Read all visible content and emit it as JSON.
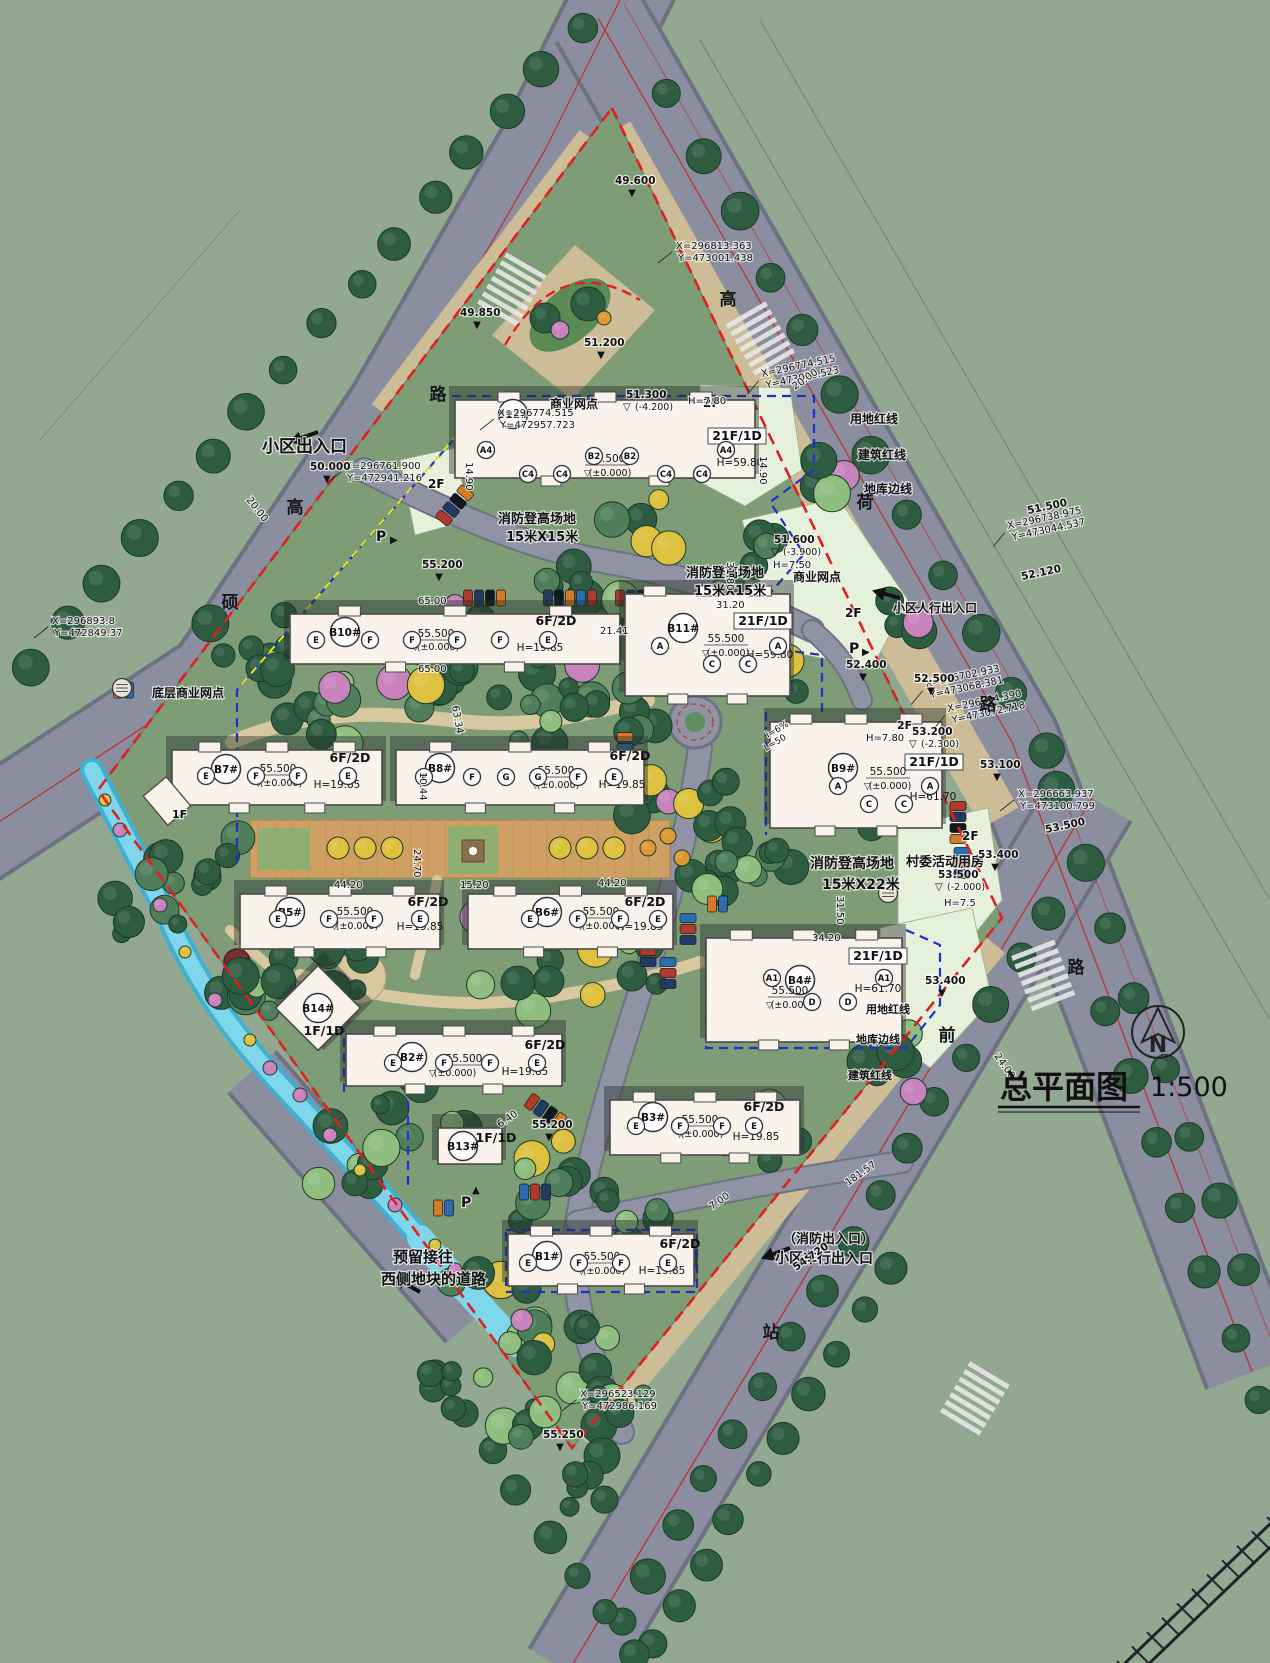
{
  "title": {
    "main": "总平面图",
    "scale": "1:500"
  },
  "north": {
    "label": "N"
  },
  "palette": {
    "background": "#93a891",
    "road": "#8a8e9e",
    "roadEdge": "#6e7180",
    "sidewalk": "#cdbd97",
    "siteGreen": "#7e9c76",
    "paleCommercial": "#e6f1dc",
    "plaza": "#cf9f63",
    "path": "#d8c8a0",
    "lawn": "#8fae6f",
    "treeDark": "#2d5c40",
    "treeMid": "#4e7f5a",
    "treeLight": "#8fbe7f",
    "treeYellow": "#ddc13f",
    "treePink": "#c883bd",
    "treeOrange": "#dd9a34",
    "water": "#7fd6ea",
    "waterDeep": "#3fb0cf",
    "building": "#f9f3ec",
    "buildingEdge": "#4a4a4a",
    "shadow": "rgba(35,45,40,0.42)",
    "redLine": "#e02020",
    "blueLine": "#2030cc",
    "yellowLine": "#e6e322",
    "text": "#111111"
  },
  "road_names": [
    {
      "ch": "路",
      "x": 438,
      "y": 400
    },
    {
      "ch": "高",
      "x": 295,
      "y": 513
    },
    {
      "ch": "硕",
      "x": 230,
      "y": 608
    },
    {
      "ch": "高",
      "x": 728,
      "y": 305
    },
    {
      "ch": "荷",
      "x": 865,
      "y": 508
    },
    {
      "ch": "路",
      "x": 988,
      "y": 710
    },
    {
      "ch": "路",
      "x": 1076,
      "y": 973
    },
    {
      "ch": "前",
      "x": 947,
      "y": 1041
    },
    {
      "ch": "站",
      "x": 771,
      "y": 1338
    }
  ],
  "buildings": [
    {
      "id": "B12#",
      "idPos": [
        513,
        414
      ],
      "slab": [
        455,
        400,
        300,
        78
      ],
      "shape": "slab",
      "floors": "21F/1D",
      "floorsPos": [
        737,
        440
      ],
      "floorsBox": true,
      "h": "H=59.80",
      "hPos": [
        740,
        466
      ],
      "elev": "55.500",
      "elevPos": [
        607,
        462
      ],
      "note": "(±0.000)",
      "notePos": [
        610,
        476
      ],
      "units": [
        [
          "A4",
          486,
          450
        ],
        [
          "C4",
          528,
          474
        ],
        [
          "C4",
          562,
          474
        ],
        [
          "B2",
          594,
          456
        ],
        [
          "B2",
          630,
          456
        ],
        [
          "C4",
          666,
          474
        ],
        [
          "C4",
          702,
          474
        ],
        [
          "A4",
          726,
          450
        ]
      ]
    },
    {
      "id": "B10#",
      "idPos": [
        345,
        632
      ],
      "slab": [
        290,
        614,
        330,
        50
      ],
      "shape": "slab",
      "floors": "6F/2D",
      "floorsPos": [
        556,
        625
      ],
      "h": "H=19.85",
      "hPos": [
        540,
        651
      ],
      "elev": "55.500",
      "elevPos": [
        436,
        637
      ],
      "note": "(±0.000)",
      "notePos": [
        438,
        650
      ],
      "units": [
        [
          "E",
          316,
          640
        ],
        [
          "F",
          370,
          640
        ],
        [
          "F",
          412,
          640
        ],
        [
          "F",
          457,
          640
        ],
        [
          "F",
          500,
          640
        ],
        [
          "E",
          548,
          640
        ]
      ]
    },
    {
      "id": "B11#",
      "idPos": [
        683,
        628
      ],
      "slab": [
        625,
        594,
        165,
        102
      ],
      "shape": "tower",
      "floors": "21F/1D",
      "floorsPos": [
        763,
        625
      ],
      "floorsBox": true,
      "h": "H=59.80",
      "hPos": [
        770,
        658
      ],
      "elev": "55.500",
      "elevPos": [
        726,
        642
      ],
      "note": "(±0.000)",
      "notePos": [
        728,
        656
      ],
      "units": [
        [
          "A",
          660,
          646
        ],
        [
          "A",
          778,
          646
        ],
        [
          "C",
          712,
          664
        ],
        [
          "C",
          748,
          664
        ]
      ]
    },
    {
      "id": "B7#",
      "idPos": [
        226,
        769
      ],
      "slab": [
        172,
        750,
        210,
        55
      ],
      "shape": "slab",
      "floors": "6F/2D",
      "floorsPos": [
        350,
        762
      ],
      "h": "H=19.85",
      "hPos": [
        337,
        788
      ],
      "elev": "55.500",
      "elevPos": [
        278,
        772
      ],
      "note": "(±0.000)",
      "notePos": [
        281,
        786
      ],
      "units": [
        [
          "E",
          206,
          776
        ],
        [
          "F",
          256,
          776
        ],
        [
          "F",
          298,
          776
        ],
        [
          "E",
          348,
          776
        ]
      ]
    },
    {
      "id": "B8#",
      "idPos": [
        440,
        768
      ],
      "slab": [
        396,
        750,
        248,
        55
      ],
      "shape": "slab",
      "floors": "6F/2D",
      "floorsPos": [
        630,
        760
      ],
      "h": "H=19.85",
      "hPos": [
        622,
        788
      ],
      "elev": "55.500",
      "elevPos": [
        556,
        774
      ],
      "note": "(±0.000)",
      "notePos": [
        558,
        788
      ],
      "units": [
        [
          "E",
          424,
          777
        ],
        [
          "F",
          472,
          777
        ],
        [
          "G",
          506,
          777
        ],
        [
          "G",
          538,
          777
        ],
        [
          "F",
          578,
          777
        ],
        [
          "E",
          614,
          777
        ]
      ]
    },
    {
      "id": "B9#",
      "idPos": [
        843,
        768
      ],
      "slab": [
        770,
        722,
        172,
        106
      ],
      "shape": "tower",
      "floors": "21F/1D",
      "floorsPos": [
        934,
        766
      ],
      "floorsBox": true,
      "h": "H=61.70",
      "hPos": [
        933,
        800
      ],
      "elev": "55.500",
      "elevPos": [
        888,
        775
      ],
      "note": "(±0.000)",
      "notePos": [
        890,
        789
      ],
      "units": [
        [
          "A",
          838,
          786
        ],
        [
          "A",
          930,
          786
        ],
        [
          "C",
          869,
          804
        ],
        [
          "C",
          904,
          804
        ]
      ]
    },
    {
      "id": "B5#",
      "idPos": [
        290,
        912
      ],
      "slab": [
        240,
        894,
        200,
        55
      ],
      "shape": "slab",
      "floors": "6F/2D",
      "floorsPos": [
        428,
        906
      ],
      "h": "H=19.85",
      "hPos": [
        420,
        930
      ],
      "elev": "55.500",
      "elevPos": [
        355,
        915
      ],
      "note": "(±0.000)",
      "notePos": [
        357,
        929
      ],
      "units": [
        [
          "E",
          278,
          919
        ],
        [
          "F",
          329,
          919
        ],
        [
          "F",
          374,
          919
        ],
        [
          "E",
          420,
          919
        ]
      ]
    },
    {
      "id": "B6#",
      "idPos": [
        547,
        912
      ],
      "slab": [
        468,
        894,
        205,
        55
      ],
      "shape": "slab",
      "floors": "6F/2D",
      "floorsPos": [
        645,
        906
      ],
      "h": "H=19.85",
      "hPos": [
        640,
        930
      ],
      "elev": "55.500",
      "elevPos": [
        601,
        915
      ],
      "note": "(±0.000)",
      "notePos": [
        603,
        929
      ],
      "units": [
        [
          "E",
          530,
          919
        ],
        [
          "F",
          578,
          919
        ],
        [
          "F",
          620,
          919
        ],
        [
          "E",
          658,
          919
        ]
      ]
    },
    {
      "id": "B4#",
      "idPos": [
        800,
        980
      ],
      "slab": [
        706,
        938,
        196,
        104
      ],
      "shape": "tower",
      "floors": "21F/1D",
      "floorsPos": [
        878,
        960
      ],
      "floorsBox": true,
      "h": "H=61.70",
      "hPos": [
        878,
        992
      ],
      "elev": "55.500",
      "elevPos": [
        790,
        994
      ],
      "note": "(±0.000)",
      "notePos": [
        792,
        1008
      ],
      "units": [
        [
          "A1",
          772,
          978
        ],
        [
          "A1",
          884,
          978
        ],
        [
          "D",
          812,
          1002
        ],
        [
          "D",
          848,
          1002
        ]
      ]
    },
    {
      "id": "B2#",
      "idPos": [
        412,
        1057
      ],
      "slab": [
        346,
        1034,
        216,
        52
      ],
      "shape": "slab",
      "floors": "6F/2D",
      "floorsPos": [
        545,
        1049
      ],
      "h": "H=19.85",
      "hPos": [
        525,
        1075
      ],
      "elev": "55.500",
      "elevPos": [
        464,
        1062
      ],
      "note": "(±0.000)",
      "notePos": [
        455,
        1076
      ],
      "units": [
        [
          "E",
          393,
          1063
        ],
        [
          "F",
          444,
          1063
        ],
        [
          "F",
          490,
          1063
        ],
        [
          "E",
          537,
          1063
        ]
      ]
    },
    {
      "id": "B3#",
      "idPos": [
        653,
        1117
      ],
      "slab": [
        610,
        1100,
        190,
        55
      ],
      "shape": "slab",
      "floors": "6F/2D",
      "floorsPos": [
        764,
        1111
      ],
      "h": "H=19.85",
      "hPos": [
        756,
        1140
      ],
      "elev": "55.500",
      "elevPos": [
        700,
        1123
      ],
      "note": "(±0.000)",
      "notePos": [
        702,
        1137
      ],
      "units": [
        [
          "E",
          636,
          1126
        ],
        [
          "F",
          680,
          1126
        ],
        [
          "F",
          722,
          1126
        ],
        [
          "E",
          754,
          1126
        ]
      ]
    },
    {
      "id": "B1#",
      "idPos": [
        547,
        1256
      ],
      "slab": [
        508,
        1234,
        186,
        52
      ],
      "shape": "slab",
      "floors": "6F/2D",
      "floorsPos": [
        680,
        1248
      ],
      "h": "H=19.85",
      "hPos": [
        662,
        1274
      ],
      "elev": "55.500",
      "elevPos": [
        602,
        1260
      ],
      "note": "(±0.000)",
      "notePos": [
        604,
        1274
      ],
      "units": [
        [
          "E",
          528,
          1263
        ],
        [
          "F",
          579,
          1263
        ],
        [
          "F",
          621,
          1263
        ],
        [
          "E",
          668,
          1263
        ]
      ]
    },
    {
      "id": "B13#",
      "idPos": [
        463,
        1146
      ],
      "slab": [
        438,
        1128,
        64,
        36
      ],
      "shape": "small",
      "floors": "1F/1D",
      "floorsPos": [
        496,
        1142
      ]
    },
    {
      "id": "B14#",
      "idPos": [
        318,
        1008
      ],
      "slab": [
        288,
        978,
        60,
        60
      ],
      "shape": "diamond",
      "floors": "1F/1D",
      "floorsPos": [
        324,
        1035
      ]
    }
  ],
  "annotations": [
    {
      "t": "小区出入口",
      "x": 262,
      "y": 452,
      "s": 17,
      "b": 1
    },
    {
      "t": "商业网点",
      "x": 550,
      "y": 408,
      "s": 12,
      "b": 1
    },
    {
      "t": "2F",
      "x": 703,
      "y": 407,
      "s": 12,
      "b": 1
    },
    {
      "t": "2F",
      "x": 428,
      "y": 488,
      "s": 12,
      "b": 1
    },
    {
      "t": "消防登高场地",
      "x": 498,
      "y": 523,
      "s": 13,
      "b": 1
    },
    {
      "t": "15米X15米",
      "x": 506,
      "y": 541,
      "s": 13,
      "b": 1
    },
    {
      "t": "消防登高场地",
      "x": 686,
      "y": 577,
      "s": 13,
      "b": 1
    },
    {
      "t": "15米X15米",
      "x": 694,
      "y": 595,
      "s": 13,
      "b": 1
    },
    {
      "t": "商业网点",
      "x": 793,
      "y": 581,
      "s": 12,
      "b": 1
    },
    {
      "t": "2F",
      "x": 845,
      "y": 617,
      "s": 12,
      "b": 1
    },
    {
      "t": "小区人行出入口",
      "x": 893,
      "y": 612,
      "s": 12,
      "b": 1
    },
    {
      "t": "底层商业网点",
      "x": 152,
      "y": 697,
      "s": 12,
      "b": 1
    },
    {
      "t": "1F",
      "x": 172,
      "y": 818,
      "s": 11,
      "b": 1
    },
    {
      "t": "2F",
      "x": 897,
      "y": 729,
      "s": 11,
      "b": 1
    },
    {
      "t": "H=7.80",
      "x": 866,
      "y": 741,
      "s": 10
    },
    {
      "t": "H=7.80",
      "x": 688,
      "y": 404,
      "s": 10
    },
    {
      "t": "H=7.50",
      "x": 773,
      "y": 568,
      "s": 10
    },
    {
      "t": "村委活动用房",
      "x": 906,
      "y": 866,
      "s": 13,
      "b": 1
    },
    {
      "t": "2F",
      "x": 962,
      "y": 840,
      "s": 12,
      "b": 1
    },
    {
      "t": "消防登高场地",
      "x": 810,
      "y": 868,
      "s": 14,
      "b": 1
    },
    {
      "t": "15米X22米",
      "x": 822,
      "y": 889,
      "s": 14,
      "b": 1
    },
    {
      "t": "H=7.5",
      "x": 944,
      "y": 906,
      "s": 10
    },
    {
      "t": "用地红线",
      "x": 850,
      "y": 423,
      "s": 12,
      "b": 1
    },
    {
      "t": "建筑红线",
      "x": 858,
      "y": 459,
      "s": 12,
      "b": 1
    },
    {
      "t": "地库边线",
      "x": 864,
      "y": 493,
      "s": 12,
      "b": 1
    },
    {
      "t": "用地红线",
      "x": 866,
      "y": 1013,
      "s": 11,
      "b": 1
    },
    {
      "t": "地库边线",
      "x": 856,
      "y": 1043,
      "s": 11,
      "b": 1
    },
    {
      "t": "建筑红线",
      "x": 848,
      "y": 1079,
      "s": 11,
      "b": 1
    },
    {
      "t": "（消防出入口）",
      "x": 783,
      "y": 1243,
      "s": 13,
      "b": 1
    },
    {
      "t": "小区车行出入口",
      "x": 775,
      "y": 1263,
      "s": 14,
      "b": 1
    },
    {
      "t": "预留接往",
      "x": 393,
      "y": 1262,
      "s": 15,
      "b": 1
    },
    {
      "t": "西侧地块的道路",
      "x": 381,
      "y": 1284,
      "s": 15,
      "b": 1
    },
    {
      "t": "P",
      "x": 376,
      "y": 541,
      "s": 14,
      "b": 1
    },
    {
      "t": "P",
      "x": 849,
      "y": 653,
      "s": 14,
      "b": 1
    },
    {
      "t": "P",
      "x": 461,
      "y": 1207,
      "s": 14,
      "b": 1
    },
    {
      "t": "i=6%",
      "x": 768,
      "y": 738,
      "s": 9,
      "r": -30
    },
    {
      "t": "L=50",
      "x": 766,
      "y": 751,
      "s": 9,
      "r": -30
    }
  ],
  "coordinates": [
    {
      "l1": "X=296813.363",
      "l2": "Y=473001.438",
      "x": 676,
      "y": 249,
      "r": 0
    },
    {
      "l1": "X=296774.515",
      "l2": "Y=473020.523",
      "x": 762,
      "y": 377,
      "r": -12
    },
    {
      "l1": "X=296774.515",
      "l2": "Y=472957.723",
      "x": 498,
      "y": 416,
      "r": 0
    },
    {
      "l1": "X=296761.900",
      "l2": "Y=472941.216",
      "x": 345,
      "y": 469,
      "r": 0
    },
    {
      "l1": "X=296893.8",
      "l2": "Y=472849.37",
      "x": 52,
      "y": 624,
      "r": 0
    },
    {
      "l1": "X=296738.975",
      "l2": "Y=473044.537",
      "x": 1008,
      "y": 529,
      "r": -12
    },
    {
      "l1": "X=296702.933",
      "l2": "Y=473068.381",
      "x": 926,
      "y": 687,
      "r": -12
    },
    {
      "l1": "X=296694.390",
      "l2": "Y=473072.718",
      "x": 948,
      "y": 712,
      "r": -12
    },
    {
      "l1": "X=296663.937",
      "l2": "Y=473100.799",
      "x": 1018,
      "y": 797,
      "r": 0
    },
    {
      "l1": "X=296523.129",
      "l2": "Y=472986.169",
      "x": 580,
      "y": 1397,
      "r": 0
    }
  ],
  "elevations": [
    {
      "v": "49.600",
      "x": 615,
      "y": 184,
      "m": "▼"
    },
    {
      "v": "49.850",
      "x": 460,
      "y": 316,
      "m": "▼"
    },
    {
      "v": "51.200",
      "x": 584,
      "y": 346,
      "m": "▼"
    },
    {
      "v": "50.000",
      "x": 310,
      "y": 470,
      "m": "▼"
    },
    {
      "v": "51.300",
      "x": 626,
      "y": 398,
      "m": "▽",
      "note": "(-4.200)"
    },
    {
      "v": "55.200",
      "x": 422,
      "y": 568,
      "m": "▼"
    },
    {
      "v": "51.600",
      "x": 774,
      "y": 543,
      "m": "▽",
      "note": "(-3.900)"
    },
    {
      "v": "51.500",
      "x": 1028,
      "y": 514,
      "m": "",
      "r": -12
    },
    {
      "v": "52.120",
      "x": 1022,
      "y": 580,
      "m": "",
      "r": -12
    },
    {
      "v": "52.400",
      "x": 846,
      "y": 668,
      "m": "▼"
    },
    {
      "v": "52.500",
      "x": 914,
      "y": 682,
      "m": "▼"
    },
    {
      "v": "53.200",
      "x": 912,
      "y": 735,
      "m": "▽",
      "note": "(-2.300)"
    },
    {
      "v": "53.100",
      "x": 980,
      "y": 768,
      "m": "▼"
    },
    {
      "v": "53.400",
      "x": 978,
      "y": 858,
      "m": "▼"
    },
    {
      "v": "53.500",
      "x": 938,
      "y": 878,
      "m": "▽",
      "note": "(-2.000)"
    },
    {
      "v": "53.400",
      "x": 925,
      "y": 984,
      "m": "▼"
    },
    {
      "v": "53.500",
      "x": 1046,
      "y": 833,
      "m": "",
      "r": -12
    },
    {
      "v": "55.200",
      "x": 532,
      "y": 1128,
      "m": "▼"
    },
    {
      "v": "55.250",
      "x": 543,
      "y": 1438,
      "m": "▼"
    },
    {
      "v": "54.720",
      "x": 796,
      "y": 1271,
      "m": "",
      "r": -35
    }
  ],
  "dimensions": [
    {
      "v": "20.00",
      "x": 795,
      "y": 390,
      "r": -35
    },
    {
      "v": "20.00",
      "x": 246,
      "y": 500,
      "r": 52
    },
    {
      "v": "65.00",
      "x": 418,
      "y": 604,
      "r": 0
    },
    {
      "v": "65.00",
      "x": 418,
      "y": 672,
      "r": 0
    },
    {
      "v": "31.80",
      "x": 727,
      "y": 562,
      "r": 90
    },
    {
      "v": "31.20",
      "x": 716,
      "y": 608,
      "r": 0
    },
    {
      "v": "21.41",
      "x": 600,
      "y": 634,
      "r": 0
    },
    {
      "v": "14.90",
      "x": 760,
      "y": 456,
      "r": 90
    },
    {
      "v": "14.90",
      "x": 466,
      "y": 462,
      "r": 90
    },
    {
      "v": "10.44",
      "x": 420,
      "y": 772,
      "r": 90
    },
    {
      "v": "24.70",
      "x": 414,
      "y": 849,
      "r": 90
    },
    {
      "v": "15.20",
      "x": 460,
      "y": 888,
      "r": 0
    },
    {
      "v": "44.20",
      "x": 334,
      "y": 888,
      "r": 0
    },
    {
      "v": "44.20",
      "x": 598,
      "y": 886,
      "r": 0
    },
    {
      "v": "34.20",
      "x": 812,
      "y": 941,
      "r": 0
    },
    {
      "v": "31.50",
      "x": 837,
      "y": 896,
      "r": 90
    },
    {
      "v": "24.00",
      "x": 994,
      "y": 1056,
      "r": 55
    },
    {
      "v": "181.57",
      "x": 848,
      "y": 1186,
      "r": -35
    },
    {
      "v": "63.34",
      "x": 452,
      "y": 706,
      "r": 80
    },
    {
      "v": "7.00",
      "x": 712,
      "y": 1210,
      "r": -35
    },
    {
      "v": "6.40",
      "x": 500,
      "y": 1128,
      "r": -35
    }
  ]
}
